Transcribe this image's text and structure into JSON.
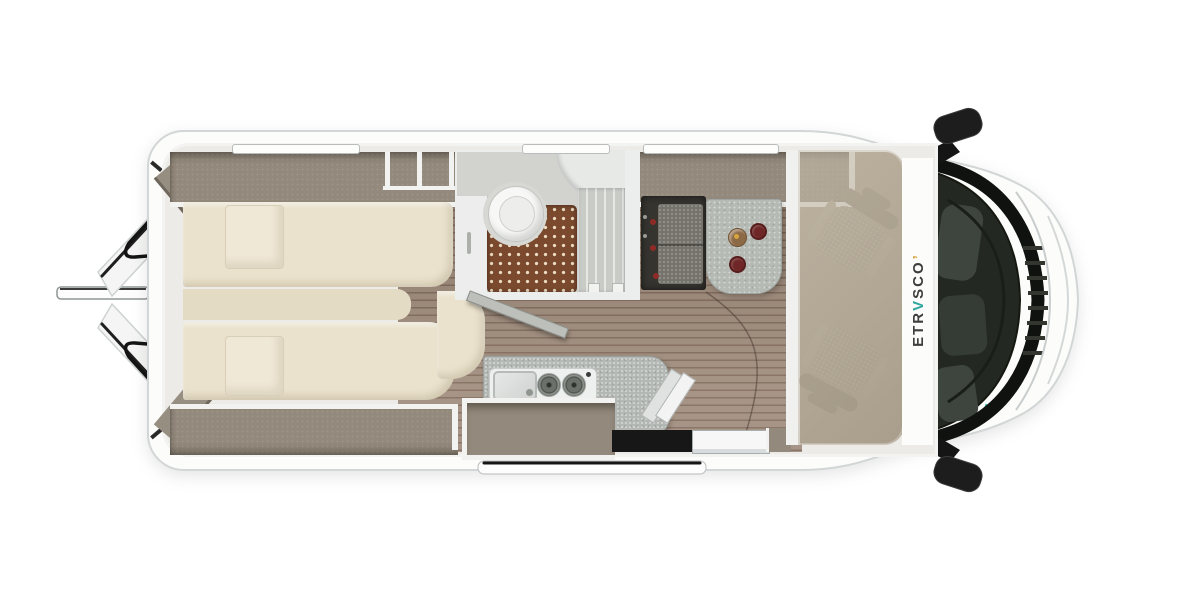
{
  "meta": {
    "title": "Etrusco campervan floor plan - top view"
  },
  "brand": {
    "pre": "ETR",
    "accent": "V",
    "post": "SCO",
    "accent_mark": "’"
  },
  "colors": {
    "wall-light": "#ecebe8",
    "lip-white": "#f2f3f1",
    "cabinet-taupe": "#93897c",
    "panel-taupe": "#978e82",
    "bed-cream": "#ebe2cd",
    "bed-shade": "#e4dbc4",
    "pillow": "#f0e8d7",
    "floor-wood": "#9c8878",
    "floor-line": "#7e6757",
    "ghost-floor": "#aca08f",
    "shower-brown": "#7b4a2e",
    "shower-dot": "#ecdcc3",
    "glass-gray": "#c9cbc7",
    "counter-gray": "#b4b8b5",
    "table-gray": "#b6bab4",
    "bench-dark": "#36342f",
    "bench-cushion": "#75736b",
    "belt-red": "#8f2b26",
    "mug-red": "#6e2626",
    "lamp-bronze": "#8d6a46",
    "lamp-gold": "#d6a63e",
    "seat-back": "#958b7a",
    "seat-cush": "#a79d8c",
    "seat-arm": "#b0a695",
    "step-dark": "#171717",
    "accent-teal": "#2fa79e",
    "windshield-dark": "#242822",
    "body-white": "#fcfcfb",
    "body-edge": "#d3d6d6"
  },
  "scene": {
    "vehicle": "campervan-top-view",
    "rear_doors_open": 2,
    "skylights": 3,
    "twin_beds": 2,
    "pillows": 2,
    "bathroom": [
      "toilet",
      "shower-tray",
      "shower-screen",
      "cabinet"
    ],
    "bench_seatbelts": 3,
    "table_items": [
      "lamp",
      "mug",
      "mug"
    ],
    "kitchen": [
      "sink",
      "faucet",
      "burner",
      "burner",
      "worktop-extension"
    ],
    "cab_seats": 2,
    "wing_mirrors": 2,
    "sliding_door_open": 1,
    "entry_step": 1
  }
}
